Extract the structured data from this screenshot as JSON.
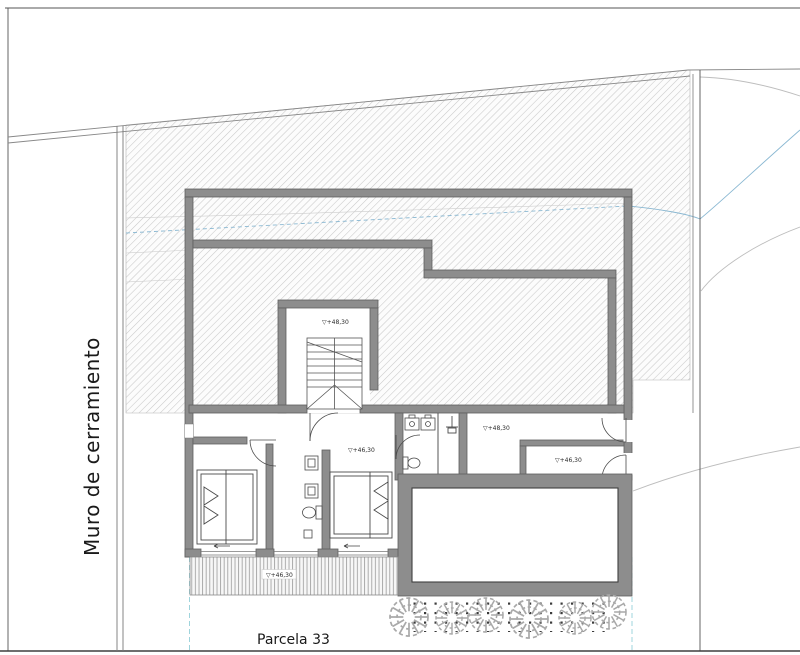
{
  "labels": {
    "enclosure_wall": "Muro de cerramiento",
    "parcel": "Parcela 33",
    "level_stairwell": "▽+48,30",
    "level_hall": "▽+46,30",
    "level_right_hall": "▽+48,30",
    "level_right_room": "▽+46,30",
    "level_terrace": "▽+46,30"
  },
  "colors": {
    "wall_fill": "#8d8d8d",
    "wall_edge": "#5f5f5f",
    "hatch_line": "#c9c9c9",
    "contour_gray": "#bdbdbd",
    "contour_blue": "#8ab8d2",
    "parcel_boundary_dashed": "#9fd4dc",
    "text": "#1a1a1a"
  }
}
